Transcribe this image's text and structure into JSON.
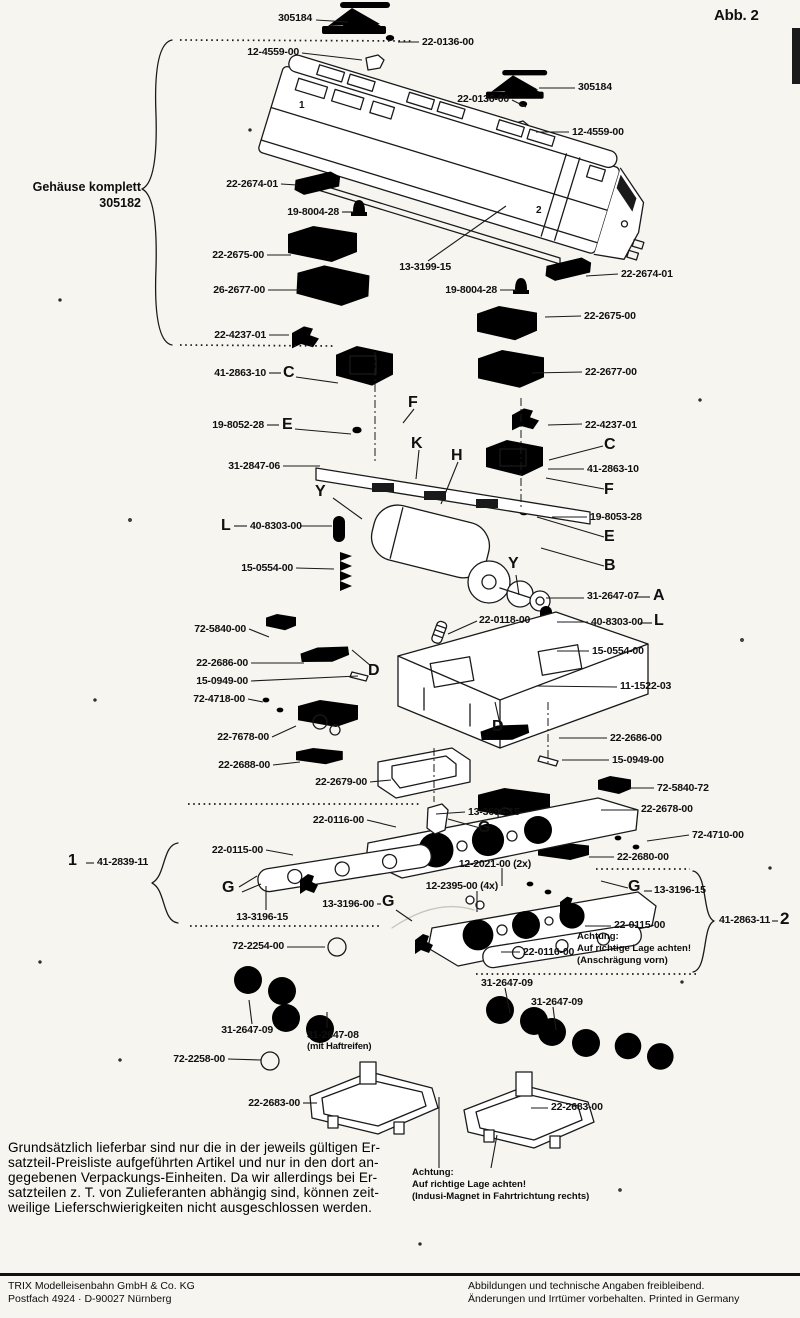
{
  "figure_label": "Abb. 2",
  "group_note": {
    "x": 141,
    "y": 180,
    "a": "r",
    "fs": 12.5,
    "lines": [
      "Gehäuse komplett",
      "305182"
    ]
  },
  "labels": [
    {
      "t": "305184",
      "x": 312,
      "y": 13,
      "a": "r",
      "ln": [
        316,
        20,
        348,
        22
      ]
    },
    {
      "t": "22-0136-00",
      "x": 422,
      "y": 37,
      "a": "l",
      "ln": [
        398,
        42,
        419,
        42
      ]
    },
    {
      "t": "12-4559-00",
      "x": 299,
      "y": 47,
      "a": "r",
      "ln": [
        302,
        53,
        362,
        60
      ]
    },
    {
      "t": "305184",
      "x": 578,
      "y": 82,
      "a": "l",
      "ln": [
        539,
        88,
        575,
        88
      ]
    },
    {
      "t": "22-0136-00",
      "x": 509,
      "y": 94,
      "a": "r",
      "ln": [
        512,
        100,
        526,
        107
      ]
    },
    {
      "t": "12-4559-00",
      "x": 572,
      "y": 127,
      "a": "l",
      "ln": [
        536,
        132,
        569,
        132
      ]
    },
    {
      "t": "22-2674-01",
      "x": 278,
      "y": 179,
      "a": "r",
      "ln": [
        281,
        184,
        297,
        185
      ]
    },
    {
      "t": "19-8004-28",
      "x": 339,
      "y": 207,
      "a": "r",
      "ln": [
        342,
        212,
        354,
        212
      ]
    },
    {
      "t": "22-2675-00",
      "x": 264,
      "y": 250,
      "a": "r",
      "ln": [
        267,
        255,
        291,
        255
      ]
    },
    {
      "t": "26-2677-00",
      "x": 265,
      "y": 285,
      "a": "r",
      "ln": [
        268,
        290,
        300,
        290
      ]
    },
    {
      "t": "22-4237-01",
      "x": 266,
      "y": 330,
      "a": "r",
      "ln": [
        269,
        335,
        289,
        335
      ]
    },
    {
      "t": "41-2863-10",
      "x": 266,
      "y": 368,
      "a": "r"
    },
    {
      "t": "13-3199-15",
      "x": 451,
      "y": 262,
      "a": "r",
      "ln": [
        428,
        261,
        506,
        206
      ]
    },
    {
      "t": "19-8004-28",
      "x": 497,
      "y": 285,
      "a": "r",
      "ln": [
        500,
        290,
        517,
        290
      ]
    },
    {
      "t": "22-2674-01",
      "x": 621,
      "y": 269,
      "a": "l",
      "ln": [
        586,
        276,
        618,
        274
      ]
    },
    {
      "t": "22-2675-00",
      "x": 584,
      "y": 311,
      "a": "l",
      "ln": [
        545,
        317,
        581,
        316
      ]
    },
    {
      "t": "22-2677-00",
      "x": 585,
      "y": 367,
      "a": "l",
      "ln": [
        532,
        373,
        582,
        372
      ]
    },
    {
      "t": "22-4237-01",
      "x": 585,
      "y": 420,
      "a": "l",
      "ln": [
        548,
        425,
        582,
        424
      ]
    },
    {
      "t": "41-2863-10",
      "x": 587,
      "y": 464,
      "a": "l",
      "ln": [
        548,
        469,
        584,
        469
      ]
    },
    {
      "t": "19-8052-28",
      "x": 264,
      "y": 420,
      "a": "r"
    },
    {
      "t": "19-8053-28",
      "x": 590,
      "y": 512,
      "a": "l",
      "ln": [
        552,
        517,
        587,
        517
      ]
    },
    {
      "t": "31-2847-06",
      "x": 280,
      "y": 461,
      "a": "r",
      "ln": [
        283,
        466,
        320,
        466
      ]
    },
    {
      "t": "40-8303-00",
      "x": 250,
      "y": 521,
      "a": "l",
      "ln": [
        300,
        526,
        332,
        526
      ]
    },
    {
      "t": "15-0554-00",
      "x": 293,
      "y": 563,
      "a": "r",
      "ln": [
        296,
        568,
        334,
        569
      ]
    },
    {
      "t": "72-5840-00",
      "x": 246,
      "y": 624,
      "a": "r",
      "ln": [
        249,
        629,
        269,
        637
      ]
    },
    {
      "t": "22-2686-00",
      "x": 248,
      "y": 658,
      "a": "r",
      "ln": [
        251,
        663,
        304,
        663
      ]
    },
    {
      "t": "15-0949-00",
      "x": 248,
      "y": 676,
      "a": "r",
      "ln": [
        251,
        681,
        358,
        676
      ]
    },
    {
      "t": "72-4718-00",
      "x": 245,
      "y": 694,
      "a": "r",
      "ln": [
        248,
        699,
        263,
        702
      ]
    },
    {
      "t": "22-7678-00",
      "x": 269,
      "y": 732,
      "a": "r",
      "ln": [
        272,
        737,
        296,
        726
      ]
    },
    {
      "t": "22-2688-00",
      "x": 270,
      "y": 760,
      "a": "r",
      "ln": [
        273,
        765,
        300,
        762
      ]
    },
    {
      "t": "22-2679-00",
      "x": 367,
      "y": 777,
      "a": "r",
      "ln": [
        370,
        782,
        391,
        780
      ]
    },
    {
      "t": "31-2647-07",
      "x": 587,
      "y": 591,
      "a": "l",
      "ln": [
        546,
        598,
        584,
        598
      ]
    },
    {
      "t": "22-0118-00",
      "x": 479,
      "y": 615,
      "a": "l",
      "ln": [
        448,
        634,
        477,
        621
      ]
    },
    {
      "t": "40-8303-00",
      "x": 591,
      "y": 617,
      "a": "l",
      "ln": [
        557,
        622,
        588,
        622
      ]
    },
    {
      "t": "15-0554-00",
      "x": 592,
      "y": 646,
      "a": "l",
      "ln": [
        557,
        651,
        589,
        651
      ]
    },
    {
      "t": "11-1522-03",
      "x": 620,
      "y": 681,
      "a": "l",
      "ln": [
        536,
        686,
        617,
        687
      ]
    },
    {
      "t": "22-2686-00",
      "x": 610,
      "y": 733,
      "a": "l",
      "ln": [
        559,
        738,
        607,
        738
      ]
    },
    {
      "t": "15-0949-00",
      "x": 612,
      "y": 755,
      "a": "l",
      "ln": [
        562,
        760,
        609,
        760
      ]
    },
    {
      "t": "72-5840-72",
      "x": 657,
      "y": 783,
      "a": "l",
      "ln": [
        629,
        788,
        654,
        788
      ]
    },
    {
      "t": "22-2678-00",
      "x": 641,
      "y": 804,
      "a": "l",
      "ln": [
        601,
        810,
        638,
        810
      ]
    },
    {
      "t": "72-4710-00",
      "x": 692,
      "y": 830,
      "a": "l",
      "ln": [
        647,
        841,
        689,
        835
      ]
    },
    {
      "t": "22-2680-00",
      "x": 617,
      "y": 852,
      "a": "l",
      "ln": [
        589,
        857,
        614,
        857
      ]
    },
    {
      "t": "13-3696-15",
      "x": 468,
      "y": 807,
      "a": "l",
      "ln": [
        436,
        814,
        465,
        812
      ]
    },
    {
      "t": "22-0116-00",
      "x": 364,
      "y": 815,
      "a": "r",
      "ln": [
        367,
        820,
        396,
        827
      ]
    },
    {
      "t": "22-0115-00",
      "x": 263,
      "y": 845,
      "a": "r",
      "ln": [
        266,
        850,
        293,
        855
      ]
    },
    {
      "t": "13-3196-15",
      "x": 288,
      "y": 912,
      "a": "r",
      "ln": [
        266,
        910,
        266,
        886
      ]
    },
    {
      "t": "13-3196-00",
      "x": 374,
      "y": 899,
      "a": "r"
    },
    {
      "t": "41-2839-11",
      "x": 97,
      "y": 857,
      "a": "l"
    },
    {
      "t": "12-2021-00 (2x)",
      "x": 531,
      "y": 859,
      "a": "r",
      "ln": [
        502,
        868,
        502,
        886
      ]
    },
    {
      "t": "12-2395-00 (4x)",
      "x": 498,
      "y": 881,
      "a": "r",
      "ln": [
        477,
        891,
        477,
        912
      ]
    },
    {
      "t": "13-3196-15",
      "x": 654,
      "y": 885,
      "a": "l"
    },
    {
      "t": "22-0115-00",
      "x": 614,
      "y": 920,
      "a": "l",
      "ln": [
        585,
        926,
        611,
        926
      ]
    },
    {
      "t": "22-0116-00",
      "x": 523,
      "y": 947,
      "a": "l",
      "ln": [
        501,
        952,
        520,
        952
      ]
    },
    {
      "t": "41-2863-11",
      "x": 719,
      "y": 915,
      "a": "l"
    },
    {
      "t": "31-2647-09",
      "x": 481,
      "y": 978,
      "a": "l",
      "ln": [
        505,
        988,
        510,
        1013
      ]
    },
    {
      "t": "31-2647-09",
      "x": 531,
      "y": 997,
      "a": "l",
      "ln": [
        553,
        1007,
        556,
        1030
      ]
    },
    {
      "t": "31-2647-09",
      "x": 273,
      "y": 1025,
      "a": "r",
      "ln": [
        252,
        1024,
        249,
        1000
      ]
    },
    {
      "t": "31-2647-08",
      "x": 307,
      "y": 1030,
      "a": "l",
      "ln": [
        327,
        1028,
        327,
        1012
      ]
    },
    {
      "t": "(mit Haftreifen)",
      "x": 307,
      "y": 1042,
      "a": "l",
      "fs": 9.5
    },
    {
      "t": "72-2254-00",
      "x": 284,
      "y": 941,
      "a": "r",
      "ln": [
        287,
        947,
        325,
        947
      ]
    },
    {
      "t": "72-2258-00",
      "x": 225,
      "y": 1054,
      "a": "r",
      "ln": [
        228,
        1059,
        261,
        1060
      ]
    },
    {
      "t": "22-2683-00",
      "x": 300,
      "y": 1098,
      "a": "r",
      "ln": [
        303,
        1103,
        317,
        1103
      ]
    },
    {
      "t": "22-2683-00",
      "x": 551,
      "y": 1102,
      "a": "l",
      "ln": [
        531,
        1108,
        548,
        1108
      ]
    },
    {
      "t": "Abb. 2",
      "x": 714,
      "y": 8,
      "a": "l",
      "fs": 15
    }
  ],
  "letters": [
    {
      "t": "C",
      "x": 283,
      "y": 365
    },
    {
      "t": "E",
      "x": 282,
      "y": 417
    },
    {
      "t": "L",
      "x": 221,
      "y": 518
    },
    {
      "t": "F",
      "x": 408,
      "y": 395
    },
    {
      "t": "K",
      "x": 411,
      "y": 436
    },
    {
      "t": "H",
      "x": 451,
      "y": 448
    },
    {
      "t": "Y",
      "x": 315,
      "y": 484
    },
    {
      "t": "Y",
      "x": 508,
      "y": 556
    },
    {
      "t": "D",
      "x": 368,
      "y": 663
    },
    {
      "t": "D",
      "x": 492,
      "y": 719
    },
    {
      "t": "C",
      "x": 604,
      "y": 437
    },
    {
      "t": "F",
      "x": 604,
      "y": 482
    },
    {
      "t": "E",
      "x": 604,
      "y": 529
    },
    {
      "t": "B",
      "x": 604,
      "y": 558
    },
    {
      "t": "A",
      "x": 653,
      "y": 588
    },
    {
      "t": "L",
      "x": 654,
      "y": 613
    },
    {
      "t": "G",
      "x": 222,
      "y": 880
    },
    {
      "t": "G",
      "x": 382,
      "y": 894
    },
    {
      "t": "G",
      "x": 478,
      "y": 820
    },
    {
      "t": "G",
      "x": 628,
      "y": 879
    },
    {
      "t": "1",
      "x": 68,
      "y": 853
    },
    {
      "t": "2",
      "x": 780,
      "y": 910,
      "fs": 17
    },
    {
      "t": "2",
      "x": 536,
      "y": 206,
      "fs": 10
    },
    {
      "t": "1",
      "x": 299,
      "y": 101,
      "fs": 10
    }
  ],
  "notes": [
    {
      "x": 577,
      "y": 931,
      "lines": [
        "Achtung:",
        "Auf richtige Lage achten!",
        "(Anschrägung vorn)"
      ]
    },
    {
      "x": 412,
      "y": 1167,
      "lines": [
        "Achtung:",
        "Auf richtige Lage achten!",
        "(Indusi-Magnet in Fahrtrichtung rechts)"
      ]
    }
  ],
  "paragraph": {
    "lines": [
      "Grundsätzlich lieferbar sind nur die in der jeweils gültigen Er-",
      "satzteil-Preisliste aufgeführten Artikel und nur in den dort an-",
      "gegebenen Verpackungs-Einheiten. Da wir allerdings bei Er-",
      "satzteilen z. T. von Zulieferanten abhängig sind, können zeit-",
      "weilige Lieferschwierigkeiten nicht ausgeschlossen werden."
    ]
  },
  "footer": {
    "left1": "TRIX Modelleisenbahn GmbH & Co. KG",
    "left2": "Postfach 4924 · D-90027 Nürnberg",
    "right1": "Abbildungen und technische Angaben freibleibend.",
    "right2": "Änderungen und Irrtümer vorbehalten. Printed in Germany"
  },
  "extra_lines": [
    [
      269,
      373,
      281,
      373
    ],
    [
      296,
      377,
      338,
      383
    ],
    [
      267,
      425,
      279,
      425
    ],
    [
      295,
      429,
      351,
      434
    ],
    [
      234,
      526,
      247,
      526
    ],
    [
      333,
      498,
      362,
      519
    ],
    [
      419,
      450,
      416,
      479
    ],
    [
      458,
      462,
      441,
      504
    ],
    [
      414,
      409,
      403,
      423
    ],
    [
      603,
      446,
      549,
      460
    ],
    [
      604,
      489,
      546,
      478
    ],
    [
      604,
      537,
      537,
      517
    ],
    [
      604,
      566,
      541,
      548
    ],
    [
      636,
      597,
      650,
      597
    ],
    [
      640,
      623,
      652,
      623
    ],
    [
      377,
      904,
      381,
      904
    ],
    [
      396,
      910,
      412,
      921
    ],
    [
      239,
      887,
      257,
      876
    ],
    [
      242,
      892,
      261,
      884
    ],
    [
      480,
      828,
      448,
      819
    ],
    [
      601,
      881,
      628,
      888
    ],
    [
      644,
      891,
      652,
      891
    ],
    [
      86,
      863,
      94,
      863
    ],
    [
      772,
      921,
      778,
      921
    ],
    [
      516,
      575,
      519,
      595
    ],
    [
      439,
      1097,
      439,
      1168
    ],
    [
      497,
      1135,
      491,
      1168
    ],
    [
      371,
      666,
      352,
      650
    ],
    [
      500,
      724,
      495,
      702
    ]
  ],
  "dotted_lines": [
    [
      180,
      40,
      414,
      41
    ],
    [
      180,
      345,
      336,
      346
    ],
    [
      188,
      804,
      420,
      804
    ],
    [
      190,
      926,
      380,
      926
    ],
    [
      596,
      869,
      690,
      869
    ],
    [
      476,
      974,
      697,
      974
    ]
  ],
  "dashdot_lines": [
    [
      375,
      352,
      375,
      464
    ],
    [
      521,
      398,
      521,
      508
    ],
    [
      548,
      702,
      548,
      764
    ],
    [
      434,
      748,
      434,
      802
    ]
  ]
}
